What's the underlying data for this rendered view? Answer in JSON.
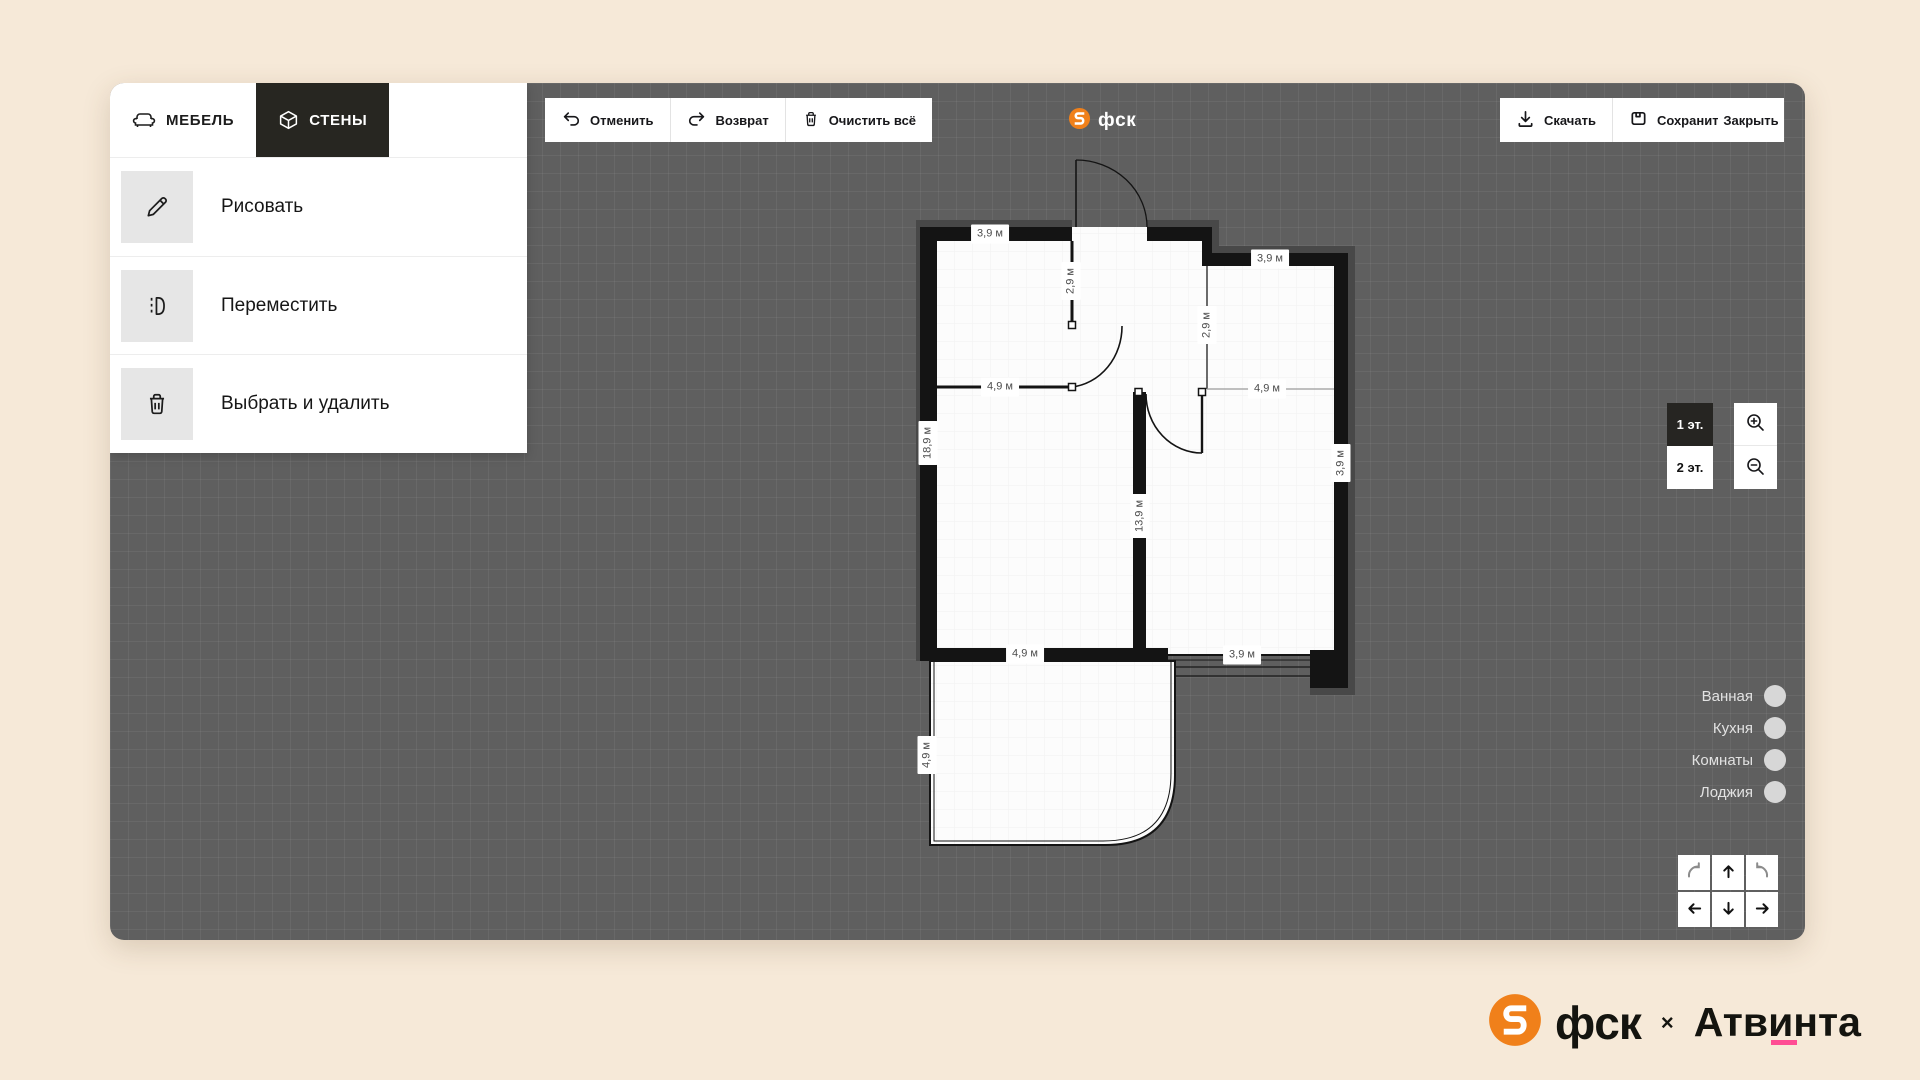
{
  "app": {
    "background": "#f6e9d8",
    "canvas_color": "#5f5f5f",
    "accent_orange": "#f0801a",
    "accent_pink": "#ff4d94",
    "active_dark": "#272621"
  },
  "sidebar": {
    "tabs": [
      {
        "label": "МЕБЕЛЬ",
        "icon": "sofa-icon",
        "active": false
      },
      {
        "label": "СТЕНЫ",
        "icon": "cube-icon",
        "active": true
      }
    ],
    "items": [
      {
        "label": "Рисовать",
        "icon": "pencil-icon"
      },
      {
        "label": "Переместить",
        "icon": "move-wall-icon"
      },
      {
        "label": "Выбрать и удалить",
        "icon": "trash-icon"
      }
    ]
  },
  "toolbar": {
    "undo": "Отменить",
    "redo": "Возврат",
    "clear": "Очистить всё"
  },
  "header": {
    "logo_text": "фск"
  },
  "actions": {
    "download": "Скачать",
    "save": "Сохранить",
    "close": "Закрыть"
  },
  "floors": [
    {
      "label": "1 эт.",
      "active": true
    },
    {
      "label": "2 эт.",
      "active": false
    }
  ],
  "legend": [
    {
      "label": "Ванная"
    },
    {
      "label": "Кухня"
    },
    {
      "label": "Комнаты"
    },
    {
      "label": "Лоджия"
    }
  ],
  "plan": {
    "labels": [
      {
        "t": "3,9 м",
        "x": 90,
        "y": 91,
        "r": 0
      },
      {
        "t": "2,9 м",
        "x": 171,
        "y": 138,
        "r": -90
      },
      {
        "t": "3,9 м",
        "x": 370,
        "y": 116,
        "r": 0
      },
      {
        "t": "2,9 м",
        "x": 307,
        "y": 182,
        "r": -90
      },
      {
        "t": "4,9 м",
        "x": 100,
        "y": 244,
        "r": 0
      },
      {
        "t": "4,9 м",
        "x": 367,
        "y": 246,
        "r": 0
      },
      {
        "t": "18,9 м",
        "x": 28,
        "y": 300,
        "r": -90
      },
      {
        "t": "3,9 м",
        "x": 441,
        "y": 320,
        "r": -90
      },
      {
        "t": "13,9 м",
        "x": 240,
        "y": 373,
        "r": -90
      },
      {
        "t": "4,9 м",
        "x": 125,
        "y": 511,
        "r": 0
      },
      {
        "t": "3,9 м",
        "x": 342,
        "y": 512,
        "r": 0
      },
      {
        "t": "4,9 м",
        "x": 27,
        "y": 612,
        "r": -90
      }
    ]
  },
  "footer": {
    "brand1": "фск",
    "separator": "×",
    "brand2": "Атвинта"
  }
}
